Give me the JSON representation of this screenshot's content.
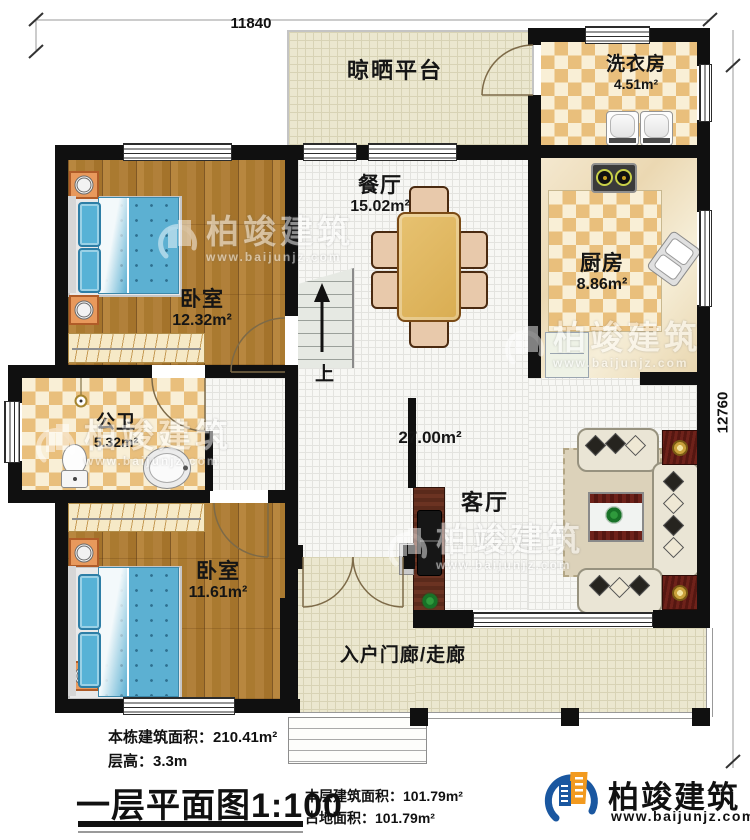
{
  "dimensions": {
    "top_width": "11840",
    "right_height": "12760"
  },
  "rooms": {
    "drying_platform": {
      "name": "晾晒平台"
    },
    "laundry": {
      "name": "洗衣房",
      "area": "4.51m²"
    },
    "kitchen": {
      "name": "厨房",
      "area": "8.86m²"
    },
    "dining": {
      "name": "餐厅",
      "area": "15.02m²"
    },
    "bedroom_top": {
      "name": "卧室",
      "area": "12.32m²"
    },
    "bathroom": {
      "name": "公卫",
      "area": "5.32m²"
    },
    "bedroom_bottom": {
      "name": "卧室",
      "area": "11.61m²"
    },
    "living": {
      "name": "客厅",
      "area": "27.00m²"
    },
    "corridor": {
      "name": "入户门廊/走廊"
    }
  },
  "stairs": {
    "up_label": "上"
  },
  "watermark": {
    "brand": "柏竣建筑",
    "url": "www.baijunjz.com"
  },
  "footer": {
    "building_total_label": "本栋建筑面积：",
    "building_total_value": "210.41m²",
    "floor_height_label": "层高：",
    "floor_height_value": "3.3m",
    "title": "一层平面图",
    "scale": "1:100",
    "floor_area_label": "本层建筑面积：",
    "floor_area_value": "101.79m²",
    "footprint_label": "占地面积：",
    "footprint_value": "101.79m²"
  },
  "brand": {
    "name": "柏竣建筑",
    "url": "www.baijunjz.com"
  }
}
